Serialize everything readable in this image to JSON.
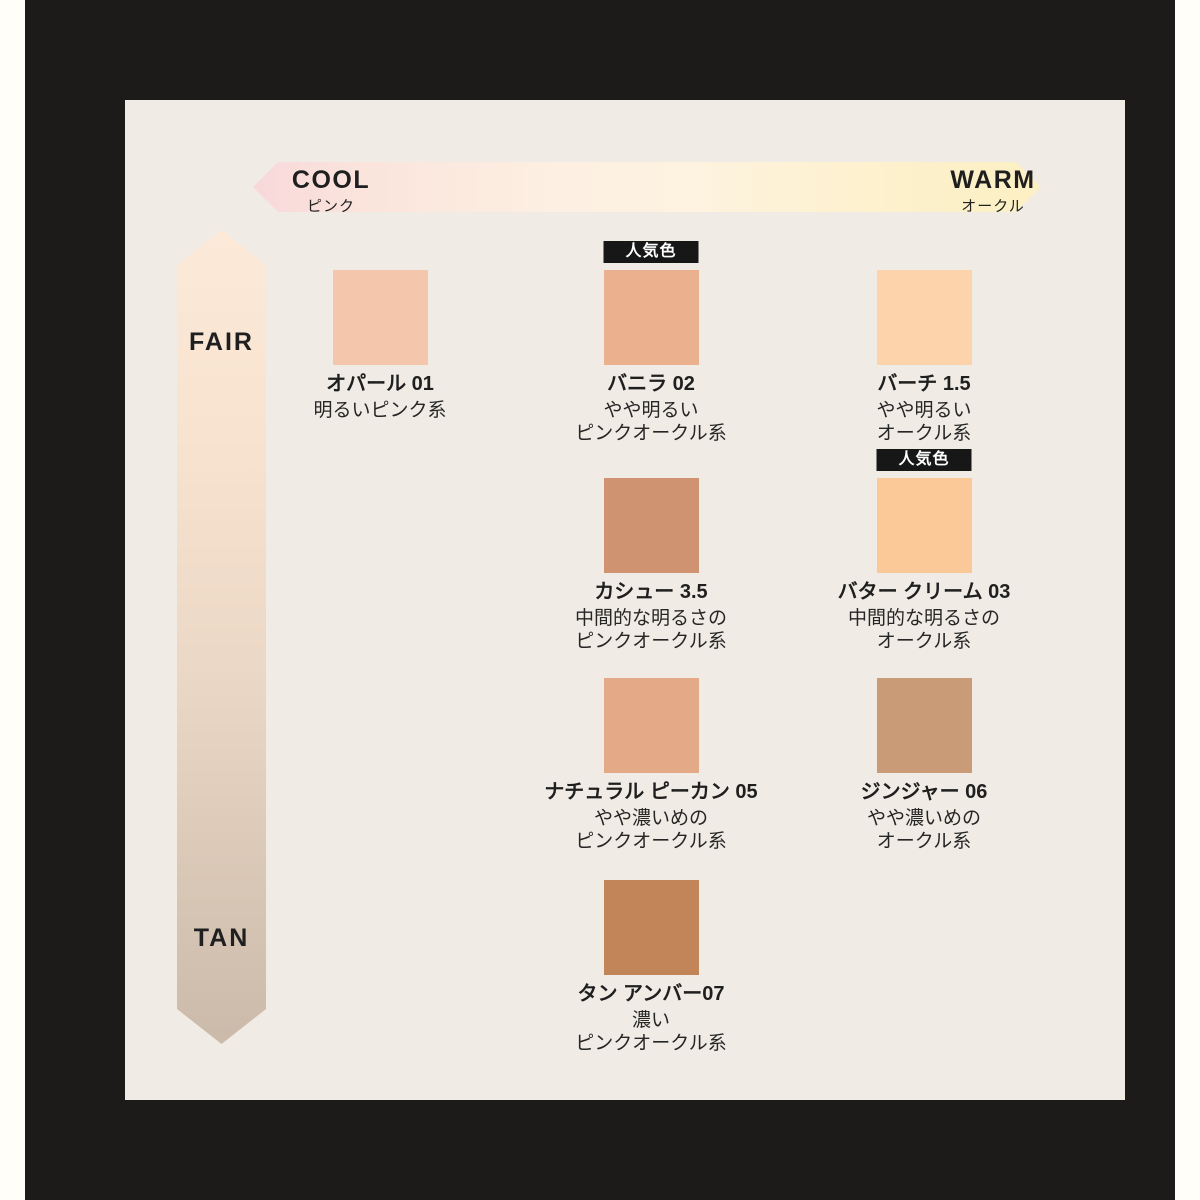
{
  "axes": {
    "horizontal": {
      "left_label": "COOL",
      "left_sublabel": "ピンク",
      "right_label": "WARM",
      "right_sublabel": "オークル",
      "gradient_left": "#f8d8da",
      "gradient_mid": "#fdf2e2",
      "gradient_right": "#fcf0c3"
    },
    "vertical": {
      "top_label": "FAIR",
      "bottom_label": "TAN",
      "gradient_top": "#fce9d8",
      "gradient_bottom": "#cbbaaa"
    }
  },
  "popular_badge_label": "人気色",
  "shades": [
    {
      "id": "opal-01",
      "name": "オパール 01",
      "desc": [
        "明るいピンク系"
      ],
      "color": "#f4c6ac",
      "popular": false,
      "col": 1,
      "row": 1
    },
    {
      "id": "vanilla-02",
      "name": "バニラ 02",
      "desc": [
        "やや明るい",
        "ピンクオークル系"
      ],
      "color": "#ebb08d",
      "popular": true,
      "col": 2,
      "row": 1
    },
    {
      "id": "birch-1-5",
      "name": "バーチ 1.5",
      "desc": [
        "やや明るい",
        "オークル系"
      ],
      "color": "#fdd3ab",
      "popular": false,
      "col": 3,
      "row": 1
    },
    {
      "id": "cashew-3-5",
      "name": "カシュー 3.5",
      "desc": [
        "中間的な明るさの",
        "ピンクオークル系"
      ],
      "color": "#cf9372",
      "popular": false,
      "col": 2,
      "row": 2
    },
    {
      "id": "butter-cream-03",
      "name": "バター クリーム 03",
      "desc": [
        "中間的な明るさの",
        "オークル系"
      ],
      "color": "#fac997",
      "popular": true,
      "col": 3,
      "row": 2
    },
    {
      "id": "natural-pecan-05",
      "name": "ナチュラル ピーカン 05",
      "desc": [
        "やや濃いめの",
        "ピンクオークル系"
      ],
      "color": "#e4aa88",
      "popular": false,
      "col": 2,
      "row": 3
    },
    {
      "id": "ginger-06",
      "name": "ジンジャー 06",
      "desc": [
        "やや濃いめの",
        "オークル系"
      ],
      "color": "#c99c77",
      "popular": false,
      "col": 3,
      "row": 3
    },
    {
      "id": "tan-amber-07",
      "name": "タン アンバー07",
      "desc": [
        "濃い",
        "ピンクオークル系"
      ],
      "color": "#c28459",
      "popular": false,
      "col": 2,
      "row": 4
    }
  ],
  "colors": {
    "page_bg": "#fffef9",
    "frame_bg": "#1c1b19",
    "card_bg": "#f0ebe4",
    "text": "#1f1f1f",
    "badge_bg": "#171717",
    "badge_text": "#ffffff"
  }
}
